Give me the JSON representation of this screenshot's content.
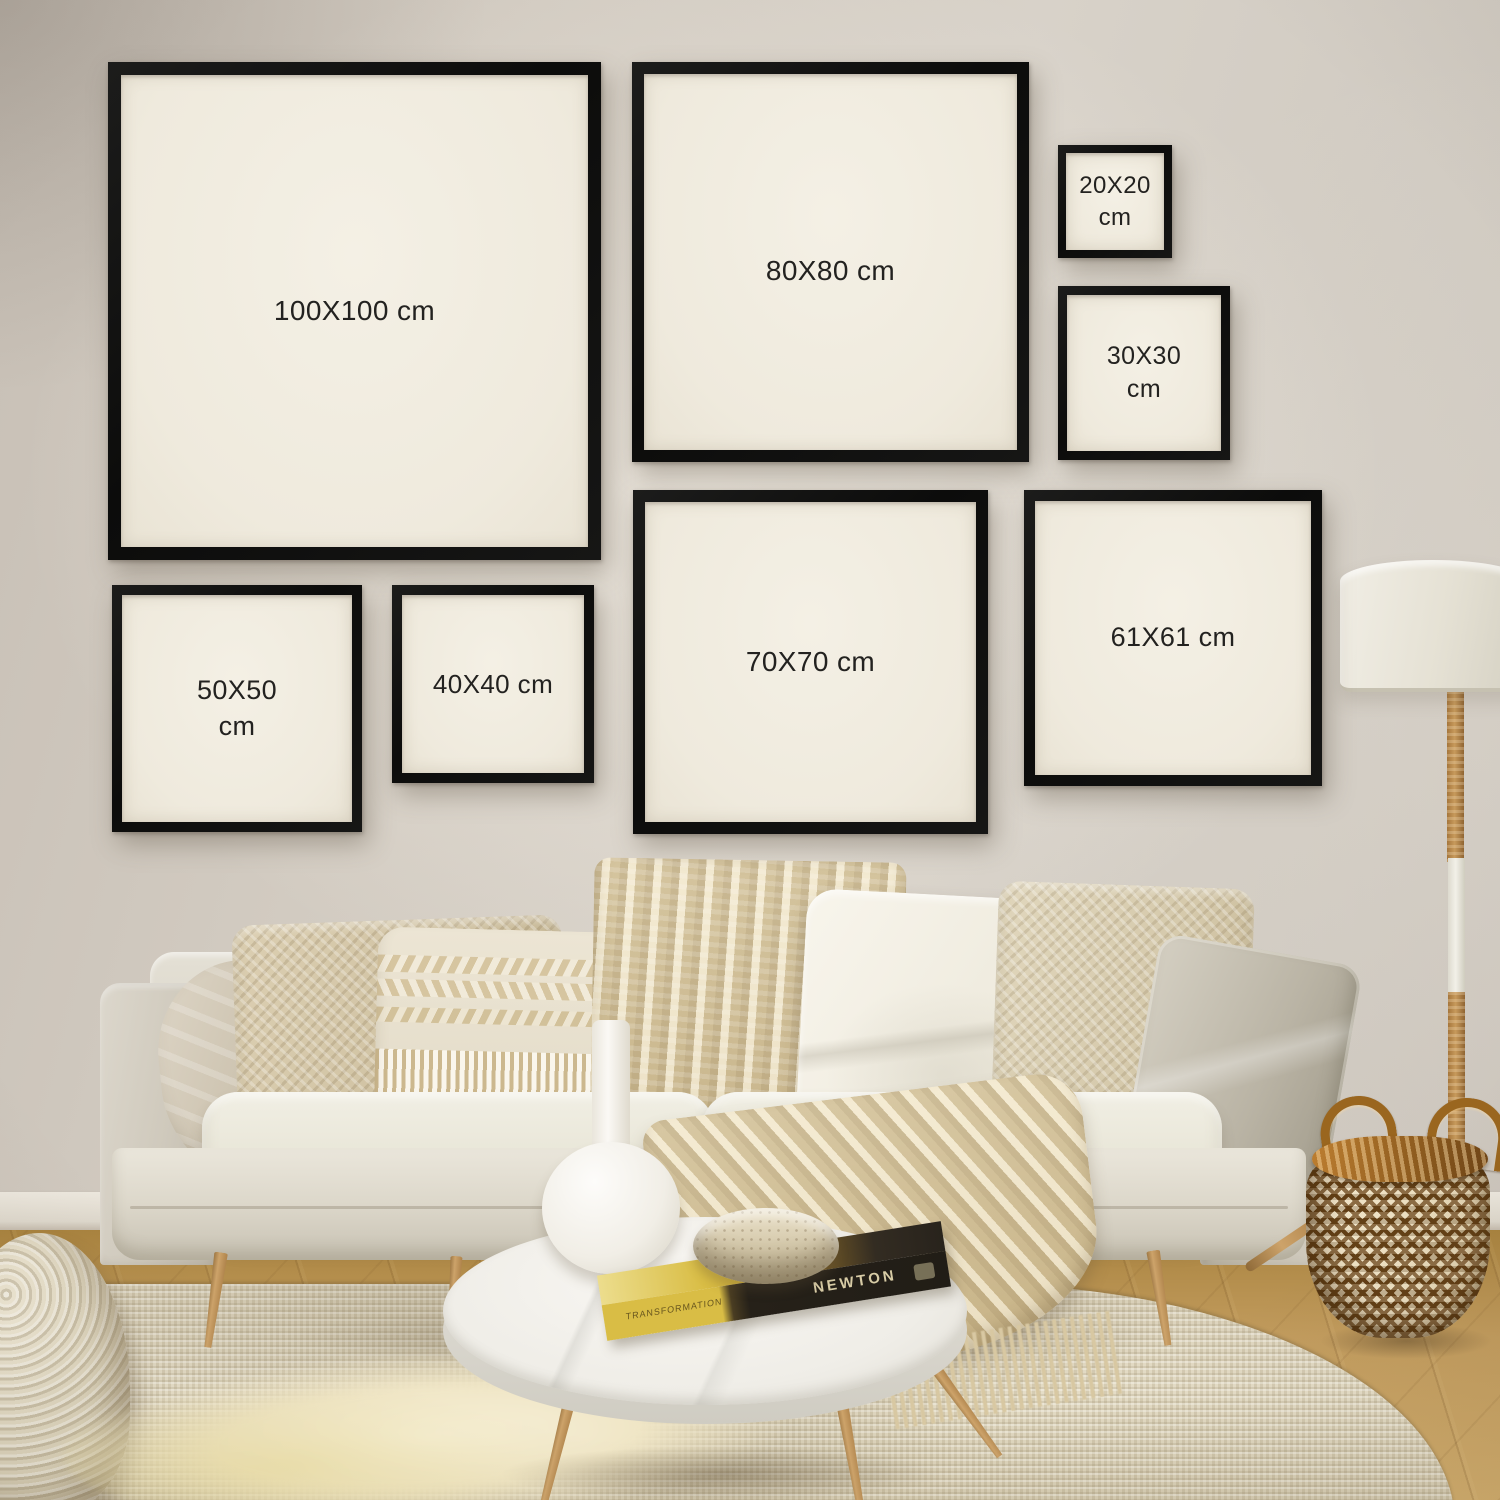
{
  "frames": [
    {
      "name": "100x100",
      "label": "100X100 cm"
    },
    {
      "name": "80x80",
      "label": "80X80 cm"
    },
    {
      "name": "20x20",
      "label": "20X20 cm"
    },
    {
      "name": "30x30",
      "label": "30X30 cm"
    },
    {
      "name": "50x50",
      "label": "50X50 cm"
    },
    {
      "name": "40x40",
      "label": "40X40 cm"
    },
    {
      "name": "70x70",
      "label": "70X70 cm"
    },
    {
      "name": "61x61",
      "label": "61X61 cm"
    }
  ],
  "decor": {
    "book_spine_text": "NEWTON",
    "book_edge_text": "TRANSFORMATION"
  },
  "colors": {
    "frame_border": "#111110",
    "frame_canvas": "#f2eee3",
    "label_text": "#232220",
    "wall": "#d4cdc3",
    "sofa": "#e3dfd4",
    "wood": "#bd9257",
    "rug": "#ded6c0",
    "basket_brown": "#7a5120",
    "throw": "#ddd0ae"
  }
}
